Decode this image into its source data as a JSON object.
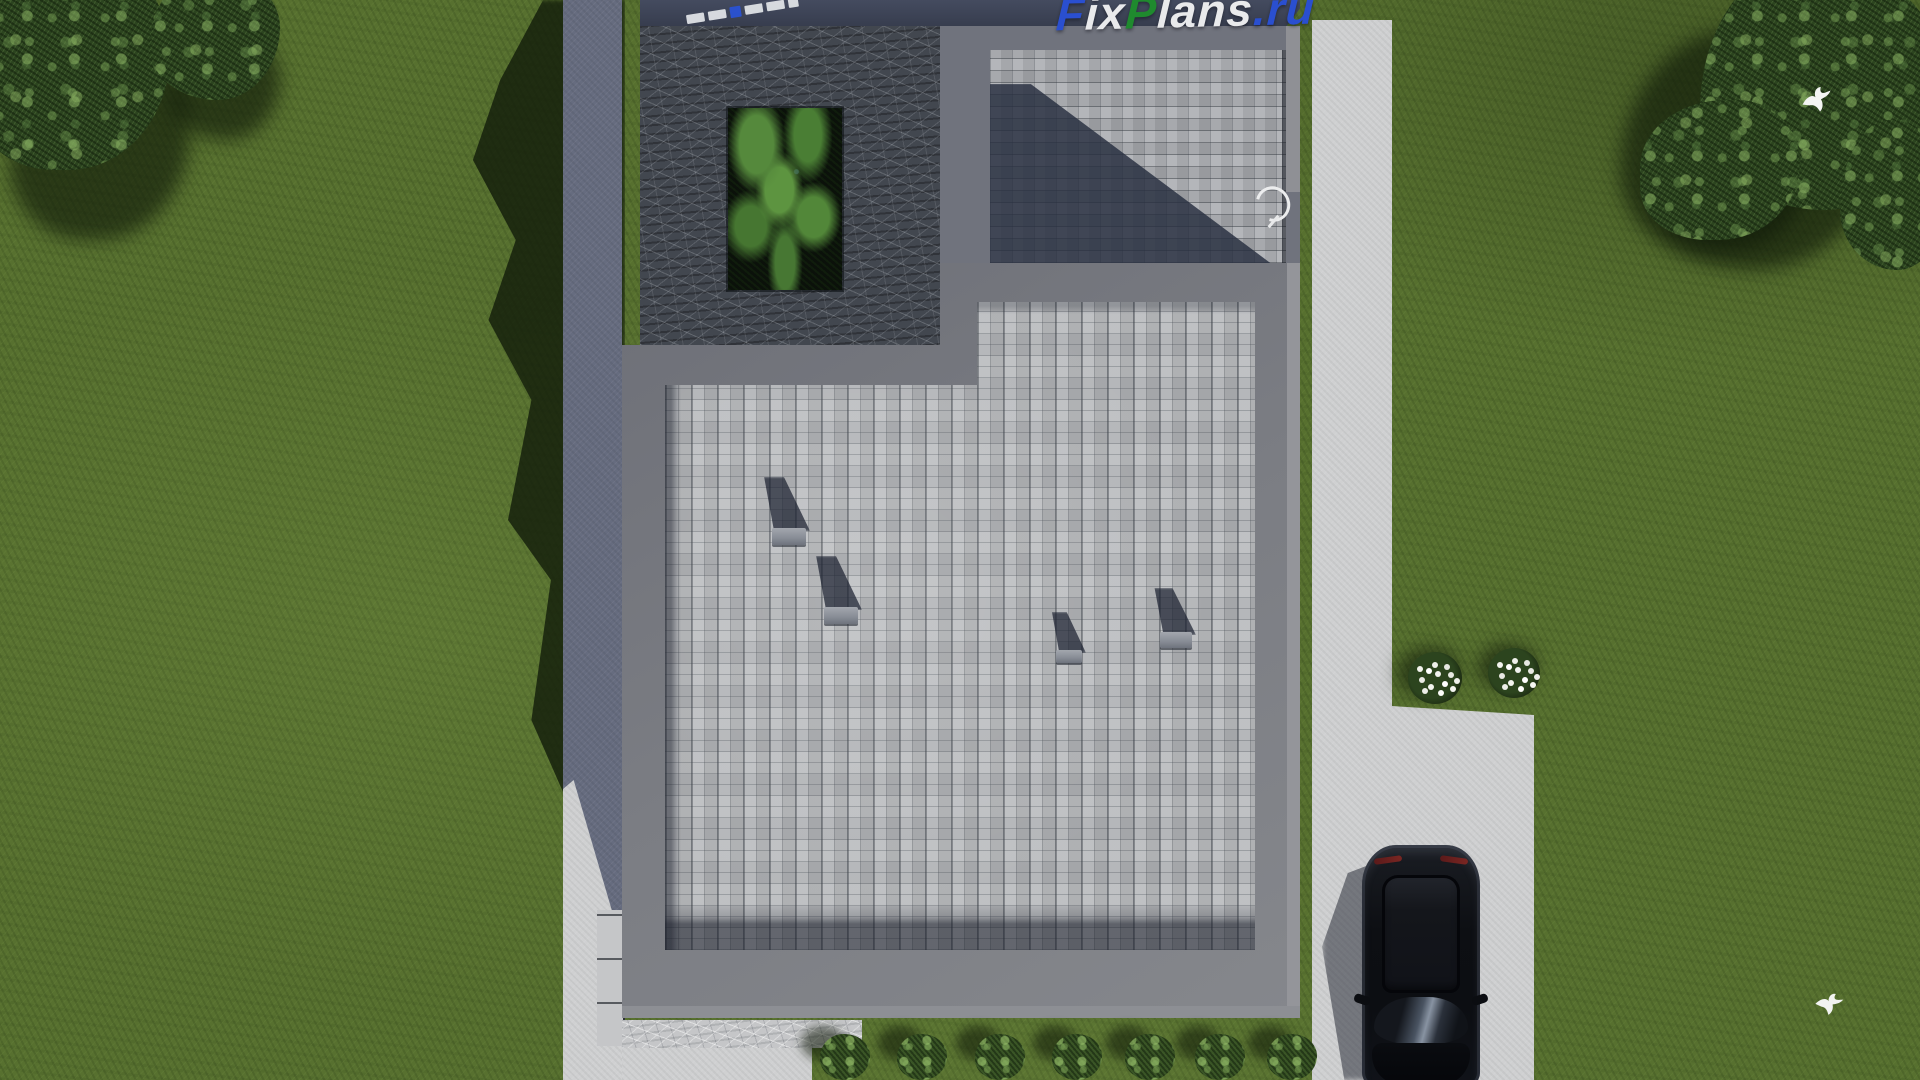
{
  "watermark": {
    "text": "FixPlans.ru",
    "segments": [
      {
        "text": "F",
        "color": "#2a4fd0"
      },
      {
        "text": "ix",
        "color": "#e9eaec"
      },
      {
        "text": "P",
        "color": "#1f8a2e"
      },
      {
        "text": "lans",
        "color": "#e9eaec"
      },
      {
        "text": ".ru",
        "color": "#2a4fd0"
      }
    ]
  },
  "scene": {
    "description": "Top-down aerial 3D render of a modern flat-roof house plan on a grass lot",
    "objects": [
      "grass-lawn",
      "tree-canopy",
      "concrete-patio",
      "roof-terrace",
      "green-roof-garden",
      "shaded-roof-court",
      "main-flat-roof",
      "roof-vent",
      "stone-walkway",
      "steps",
      "garden-path",
      "driveway",
      "black-suv-car",
      "flower-bush",
      "hedge-bush",
      "bird-icon",
      "hose-reel"
    ],
    "counts": {
      "roof_vents": 4,
      "hedge_bushes": 7,
      "flower_bushes": 2,
      "birds": 2
    },
    "colors": {
      "grass": "#57702f",
      "grass_shadow": "#1f2d14",
      "tree_canopy": "#2c441f",
      "roof_pavers": "#b5b7ba",
      "court_pavers_shadow": "#454c5e",
      "parapet": "#797b82",
      "terrace_stone": "#43484f",
      "fascia": "#3d4455",
      "concrete_shadow": "#666c7f",
      "concrete_lit": "#d2d3d4",
      "driveway": "#cfd0d1",
      "car": "#0d0f13",
      "watermark_blue": "#2a4fd0",
      "watermark_green": "#1f8a2e",
      "watermark_white": "#e9eaec"
    }
  }
}
